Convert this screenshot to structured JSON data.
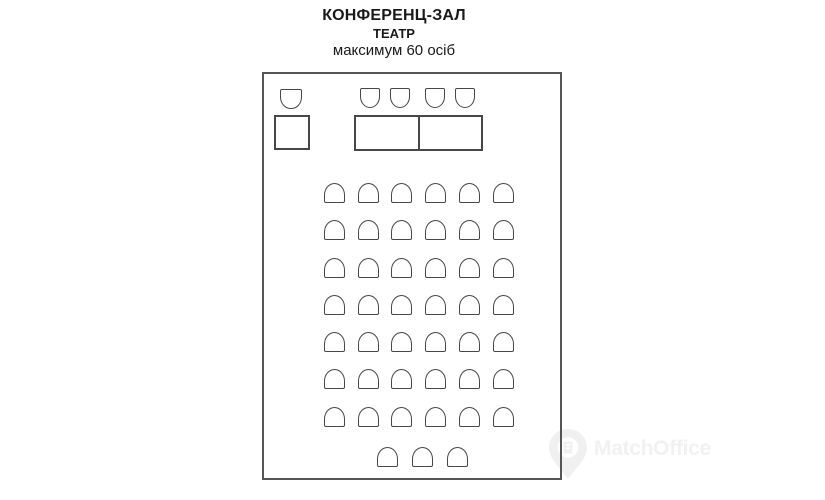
{
  "title": {
    "room_name": "КОНФЕРЕНЦ-ЗАЛ",
    "layout_name": "ТЕАТР",
    "capacity": "максимум 60 осіб"
  },
  "watermark": {
    "text": "MatchOffice",
    "icon": "location-pin-icon"
  },
  "colors": {
    "background": "#ffffff",
    "outline": "#474747",
    "room_border": "#555555",
    "watermark": "#f1f1f1",
    "title_text": "#1a1a1a"
  },
  "floorplan": {
    "room": {
      "x": 262,
      "y": 72,
      "width": 300,
      "height": 408
    },
    "stage": {
      "speaker_chair": {
        "x": 16,
        "y": 15,
        "w": 22,
        "h": 20,
        "facing": "down"
      },
      "lectern": {
        "x": 10,
        "y": 41,
        "w": 36,
        "h": 35
      },
      "head_table": {
        "x": 90,
        "y": 41,
        "w": 129,
        "h": 36,
        "sections": 2
      },
      "head_chairs": {
        "xs": [
          96,
          126,
          161,
          191
        ],
        "y": 14,
        "w": 20,
        "h": 20,
        "facing": "down"
      }
    },
    "audience": {
      "chair_w": 21,
      "chair_h": 20,
      "col_xs": [
        60,
        94,
        127,
        161,
        195,
        229
      ],
      "row_ys": [
        109,
        146,
        184,
        221,
        258,
        295,
        333
      ],
      "back_row": {
        "xs": [
          113,
          148,
          183
        ],
        "y": 373
      },
      "facing": "up"
    },
    "seats_drawn": 50
  }
}
